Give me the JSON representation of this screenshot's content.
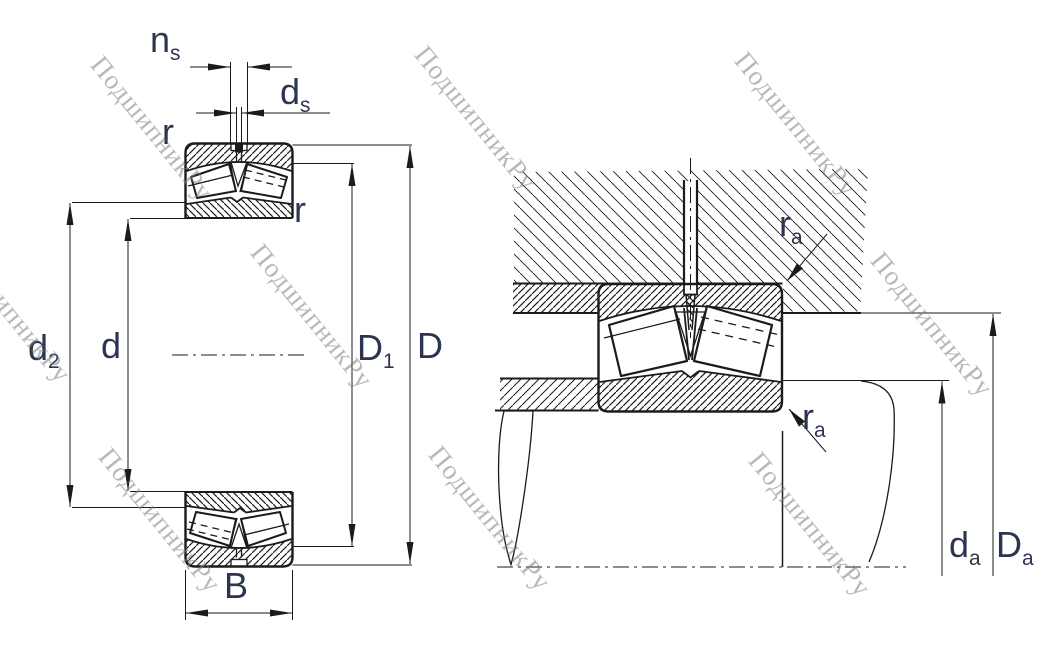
{
  "title": "Spherical roller bearing dimension drawing",
  "watermark": {
    "text": "ПодшипникРу"
  },
  "colors": {
    "line": "#1b1b1b",
    "label": "#2b3550",
    "watermark": "#7d7d7d"
  },
  "labels": {
    "ns": {
      "main": "n",
      "sub": "s"
    },
    "ds": {
      "main": "d",
      "sub": "s"
    },
    "r_top": {
      "main": "r",
      "sub": ""
    },
    "r_bore": {
      "main": "r",
      "sub": ""
    },
    "d2": {
      "main": "d",
      "sub": "2"
    },
    "d": {
      "main": "d",
      "sub": ""
    },
    "D1": {
      "main": "D",
      "sub": "1"
    },
    "D": {
      "main": "D",
      "sub": ""
    },
    "B": {
      "main": "B",
      "sub": ""
    },
    "ra_housing": {
      "main": "r",
      "sub": "a"
    },
    "ra_shaft": {
      "main": "r",
      "sub": "a"
    },
    "da": {
      "main": "d",
      "sub": "a"
    },
    "Da": {
      "main": "D",
      "sub": "a"
    }
  }
}
